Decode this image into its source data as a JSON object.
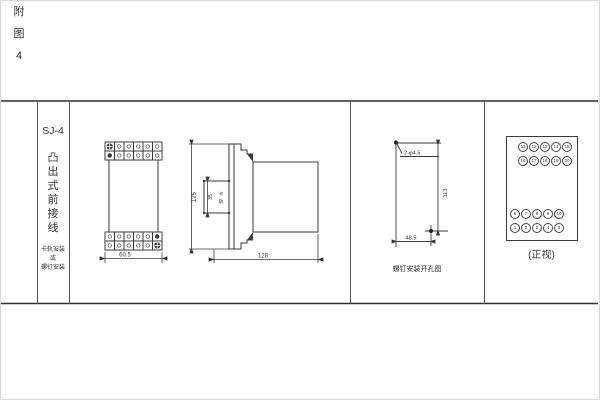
{
  "page": {
    "figure_label_chars": [
      "附",
      "图",
      "4"
    ]
  },
  "title_col": {
    "model": "SJ-4",
    "title_chars": [
      "凸",
      "出",
      "式",
      "前",
      "接",
      "线"
    ],
    "mount_lines": [
      "卡轨安装",
      "或",
      "螺钉安装"
    ]
  },
  "outline": {
    "width_dim": "60.5",
    "height_dim": "125",
    "depth_dim": "128",
    "rail_dim": "35",
    "rail_label_chars": [
      "卡",
      "轨"
    ]
  },
  "holes": {
    "hole_spec": "2-φ4.5",
    "v_dim": "113",
    "h_dim": "48.5",
    "caption": "螺钉安装开孔图"
  },
  "terminals": {
    "caption": "(正视)",
    "rows": [
      [
        "11",
        "12",
        "13",
        "14",
        "15"
      ],
      [
        "16",
        "17",
        "18",
        "19",
        "20"
      ],
      [
        "6",
        "7",
        "8",
        "9",
        "10"
      ],
      [
        "1",
        "2",
        "3",
        "4",
        "5"
      ]
    ]
  }
}
